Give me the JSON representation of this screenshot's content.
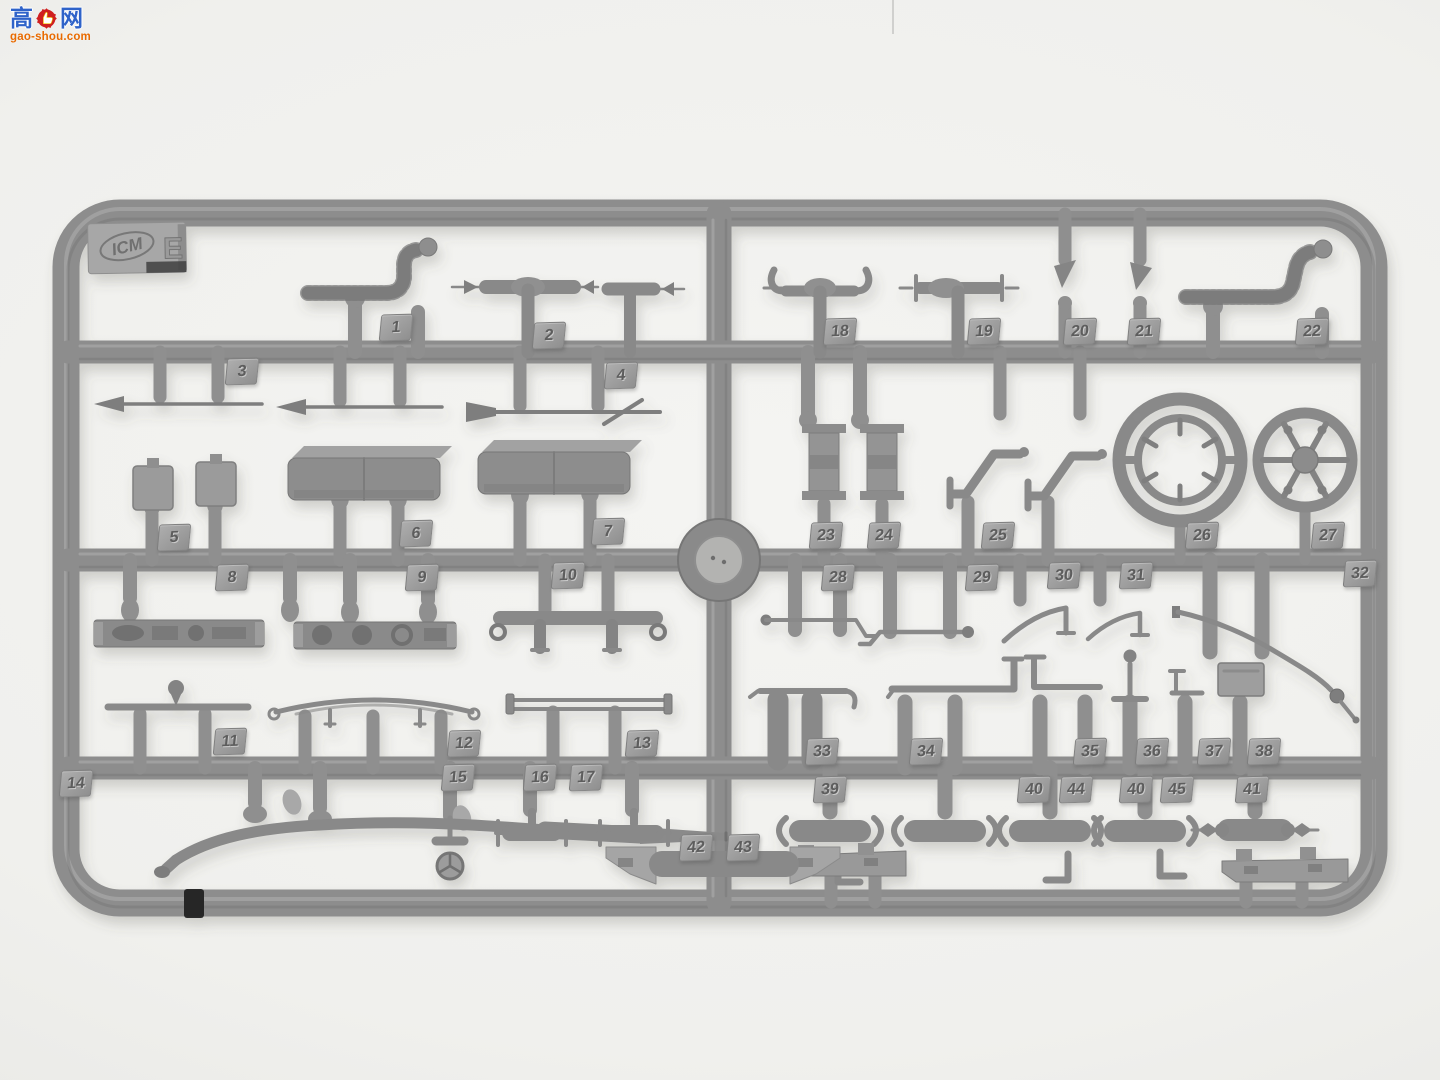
{
  "watermark": {
    "char_left": "高",
    "char_right": "网",
    "site": "gao-shou.com",
    "text_blue": "#2f63c9",
    "gear_red": "#cf1f1f",
    "url_orange": "#e86a00"
  },
  "sprue_tag": {
    "brand": "ICM",
    "letter": "E"
  },
  "colors": {
    "background": "#efefed",
    "plastic": "#8d8d8d",
    "plastic_dark": "#6f6f6f",
    "plastic_light": "#b6b6b6",
    "number_tag": "#9b9b9b"
  },
  "part_numbers": [
    {
      "n": "1",
      "x": 380,
      "y": 314
    },
    {
      "n": "2",
      "x": 533,
      "y": 322
    },
    {
      "n": "3",
      "x": 226,
      "y": 358
    },
    {
      "n": "4",
      "x": 605,
      "y": 362
    },
    {
      "n": "5",
      "x": 158,
      "y": 524
    },
    {
      "n": "6",
      "x": 400,
      "y": 520
    },
    {
      "n": "7",
      "x": 592,
      "y": 518
    },
    {
      "n": "8",
      "x": 216,
      "y": 564
    },
    {
      "n": "9",
      "x": 406,
      "y": 564
    },
    {
      "n": "10",
      "x": 552,
      "y": 562
    },
    {
      "n": "11",
      "x": 214,
      "y": 728
    },
    {
      "n": "12",
      "x": 448,
      "y": 730
    },
    {
      "n": "13",
      "x": 626,
      "y": 730
    },
    {
      "n": "14",
      "x": 60,
      "y": 770
    },
    {
      "n": "15",
      "x": 442,
      "y": 764
    },
    {
      "n": "16",
      "x": 524,
      "y": 764
    },
    {
      "n": "17",
      "x": 570,
      "y": 764
    },
    {
      "n": "18",
      "x": 824,
      "y": 318
    },
    {
      "n": "19",
      "x": 968,
      "y": 318
    },
    {
      "n": "20",
      "x": 1064,
      "y": 318
    },
    {
      "n": "21",
      "x": 1128,
      "y": 318
    },
    {
      "n": "22",
      "x": 1296,
      "y": 318
    },
    {
      "n": "23",
      "x": 810,
      "y": 522
    },
    {
      "n": "24",
      "x": 868,
      "y": 522
    },
    {
      "n": "25",
      "x": 982,
      "y": 522
    },
    {
      "n": "26",
      "x": 1186,
      "y": 522
    },
    {
      "n": "27",
      "x": 1312,
      "y": 522
    },
    {
      "n": "28",
      "x": 822,
      "y": 564
    },
    {
      "n": "29",
      "x": 966,
      "y": 564
    },
    {
      "n": "30",
      "x": 1048,
      "y": 562
    },
    {
      "n": "31",
      "x": 1120,
      "y": 562
    },
    {
      "n": "32",
      "x": 1344,
      "y": 560
    },
    {
      "n": "33",
      "x": 806,
      "y": 738
    },
    {
      "n": "34",
      "x": 910,
      "y": 738
    },
    {
      "n": "35",
      "x": 1074,
      "y": 738
    },
    {
      "n": "36",
      "x": 1136,
      "y": 738
    },
    {
      "n": "37",
      "x": 1198,
      "y": 738
    },
    {
      "n": "38",
      "x": 1248,
      "y": 738
    },
    {
      "n": "39",
      "x": 814,
      "y": 776
    },
    {
      "n": "40",
      "x": 1018,
      "y": 776
    },
    {
      "n": "44",
      "x": 1060,
      "y": 776
    },
    {
      "n": "40",
      "x": 1120,
      "y": 776
    },
    {
      "n": "45",
      "x": 1161,
      "y": 776
    },
    {
      "n": "41",
      "x": 1236,
      "y": 776
    },
    {
      "n": "42",
      "x": 680,
      "y": 834
    },
    {
      "n": "43",
      "x": 727,
      "y": 834
    }
  ]
}
